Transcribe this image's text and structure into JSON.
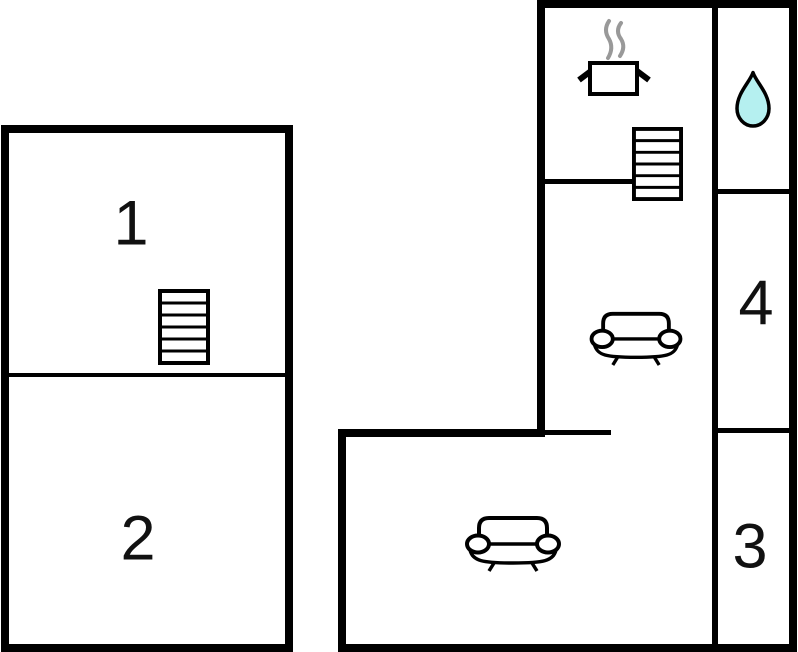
{
  "floorplan": {
    "type": "floor-plan",
    "colors": {
      "wall": "#000000",
      "background": "#ffffff",
      "drop_fill": "#b5f0f0",
      "steam": "#999999",
      "text": "#111111"
    },
    "rooms": {
      "r1": {
        "label": "1"
      },
      "r2": {
        "label": "2"
      },
      "r3": {
        "label": "3"
      },
      "r4": {
        "label": "4"
      }
    },
    "icons": {
      "left_building_stairs": "stairs-icon",
      "right_building_stairs": "stairs-icon",
      "kitchen": "cooking-pot-icon",
      "kitchen_steam": "steam-icon",
      "bathroom": "water-drop-icon",
      "lounge_upper": "sofa-icon",
      "lounge_lower": "sofa-icon"
    }
  }
}
